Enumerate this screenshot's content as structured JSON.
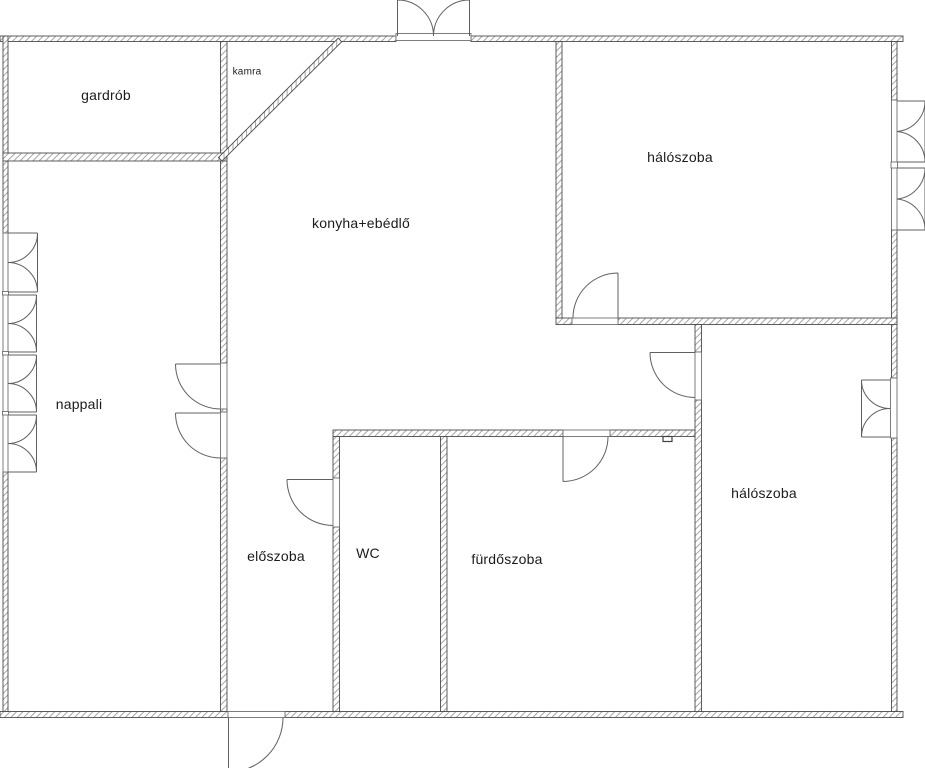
{
  "plan": {
    "type": "apartment-floor-plan",
    "language": "Hungarian",
    "colors": {
      "background": "#ffffff",
      "wall_line": "#4c4c4c",
      "wall_hatch": "#9b9b9b",
      "door_window_line": "#606060",
      "text": "#1b1b1b"
    }
  },
  "rooms": {
    "gardrob": {
      "label": "gardrób"
    },
    "kamra": {
      "label": "kamra"
    },
    "konyha": {
      "label": "konyha+ebédlő"
    },
    "haloszoba_felso": {
      "label": "hálószoba"
    },
    "nappali": {
      "label": "nappali"
    },
    "eloszoba": {
      "label": "előszoba"
    },
    "wc": {
      "label": "WC"
    },
    "furdoszoba": {
      "label": "fürdőszoba"
    },
    "haloszoba_also": {
      "label": "hálószoba"
    }
  }
}
